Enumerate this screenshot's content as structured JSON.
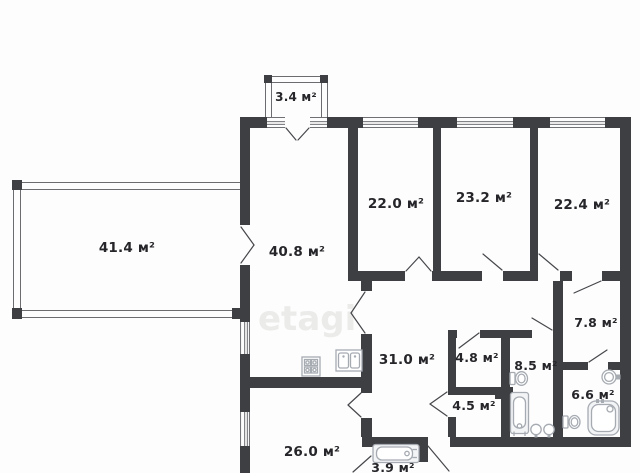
{
  "plan_title": "apartment floor plan",
  "watermark": "etagi",
  "units": "м²",
  "rooms": [
    {
      "id": "balcony-small",
      "label": "3.4 м²"
    },
    {
      "id": "terrace",
      "label": "41.4 м²"
    },
    {
      "id": "kitchen-living",
      "label": "40.8 м²"
    },
    {
      "id": "room-22-0",
      "label": "22.0 м²"
    },
    {
      "id": "room-23-2",
      "label": "23.2 м²"
    },
    {
      "id": "room-22-4",
      "label": "22.4 м²"
    },
    {
      "id": "hall",
      "label": "31.0 м²"
    },
    {
      "id": "storage-4-8",
      "label": "4.8 м²"
    },
    {
      "id": "bathroom-8-5",
      "label": "8.5 м²"
    },
    {
      "id": "room-7-8",
      "label": "7.8 м²"
    },
    {
      "id": "storage-4-5",
      "label": "4.5 м²"
    },
    {
      "id": "bathroom-6-6",
      "label": "6.6 м²"
    },
    {
      "id": "room-26-0",
      "label": "26.0 м²"
    },
    {
      "id": "bathroom-3-9",
      "label": "3.9 м²"
    }
  ],
  "colors": {
    "wall": "#3e3f43",
    "thin_line": "#6b6c70",
    "window_line": "#5a5b60",
    "door_line": "#46474b",
    "fixture": "#a6abb2",
    "text": "#26262a"
  }
}
